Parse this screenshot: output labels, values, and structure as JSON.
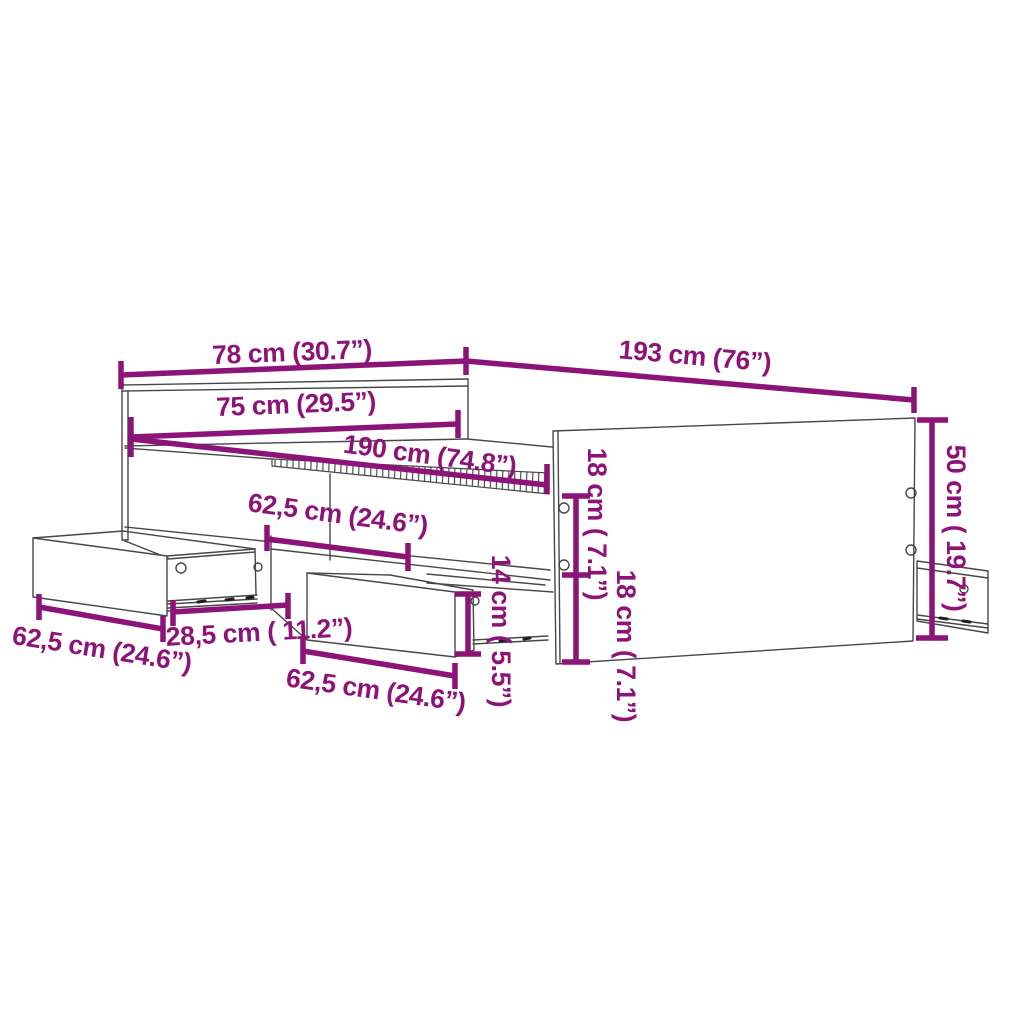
{
  "colors": {
    "dimension": "#8C1377",
    "outline": "#474747",
    "background": "#FFFFFF"
  },
  "dimensions": [
    {
      "id": "headboard-width",
      "label": "78 cm (30.7”)"
    },
    {
      "id": "frame-length",
      "label": "193 cm (76”)"
    },
    {
      "id": "inner-width",
      "label": "75 cm (29.5”)"
    },
    {
      "id": "inner-length",
      "label": "190 cm (74.8”)"
    },
    {
      "id": "side-rail-drawer-width",
      "label": "62,5 cm (24.6”)"
    },
    {
      "id": "drawer-pullout-depth",
      "label": "28,5 cm ( 11.2”)"
    },
    {
      "id": "left-drawer-width",
      "label": "62,5 cm (24.6”)"
    },
    {
      "id": "middle-drawer-width",
      "label": "62,5 cm (24.6”)"
    },
    {
      "id": "drawer-front-height",
      "label": "14 cm ( 5.5”)"
    },
    {
      "id": "upper-rail-height",
      "label": "18 cm ( 7.1”)"
    },
    {
      "id": "lower-rail-height",
      "label": "18 cm ( 7.1”)"
    },
    {
      "id": "footboard-height",
      "label": "50 cm ( 19.7”)"
    }
  ]
}
